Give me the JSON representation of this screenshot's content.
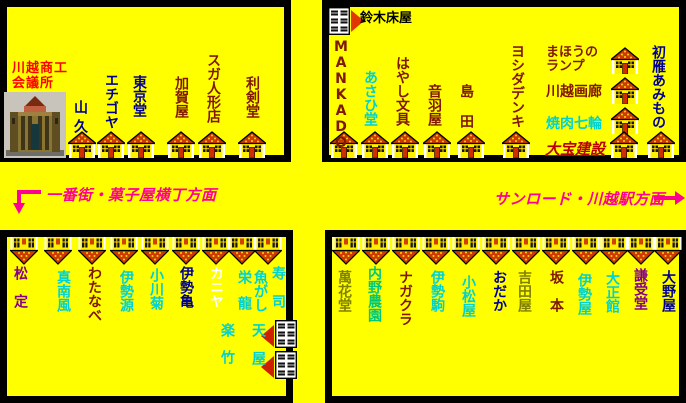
{
  "palette": {
    "background": "#FFFF00",
    "navy": "#000090",
    "maroon": "#801800",
    "olive": "#808000",
    "cyan": "#00D2D2",
    "green": "#00C878",
    "purple": "#850085",
    "white": "#FFFFFF",
    "red": "#FF0000",
    "darkred": "#B80000",
    "magenta": "#FF0095",
    "black": "#000000",
    "roof": "#CC3A00",
    "roof_dot": "#FFD800"
  },
  "landmark": {
    "name_line1": "川越商工",
    "name_line2": "会議所"
  },
  "directions": {
    "left": {
      "label": "一番街・菓子屋横丁方面"
    },
    "right": {
      "label": "サンロード・川越駅方面"
    }
  },
  "map_blocks": [
    {
      "id": "north-west",
      "x": 0,
      "y": 0,
      "w": 291,
      "h": 162,
      "shops": [
        {
          "name": "山久",
          "color": "navy",
          "dir": "v",
          "x": 73,
          "y": 100,
          "sp": 5
        },
        {
          "name": "エチゴヤ",
          "color": "navy",
          "dir": "v",
          "x": 104,
          "y": 73
        },
        {
          "name": "東京堂",
          "color": "navy",
          "dir": "v",
          "x": 132,
          "y": 75
        },
        {
          "name": "加賀屋",
          "color": "maroon",
          "dir": "v",
          "x": 174,
          "y": 76
        },
        {
          "name": "スガ人形店",
          "color": "maroon",
          "dir": "v",
          "x": 206,
          "y": 53
        },
        {
          "name": "利剣堂",
          "color": "maroon",
          "dir": "v",
          "x": 245,
          "y": 76
        }
      ],
      "houses": [
        {
          "type": "up",
          "x": 68,
          "y": 131
        },
        {
          "type": "up",
          "x": 97,
          "y": 131
        },
        {
          "type": "up",
          "x": 127,
          "y": 131
        },
        {
          "type": "up",
          "x": 167,
          "y": 131
        },
        {
          "type": "up",
          "x": 198,
          "y": 131
        },
        {
          "type": "up",
          "x": 238,
          "y": 131
        }
      ]
    },
    {
      "id": "north-east",
      "x": 322,
      "y": 0,
      "w": 364,
      "h": 162,
      "shops": [
        {
          "name": "鈴木床屋",
          "color": "black",
          "dir": "h",
          "x": 360,
          "y": 12,
          "fs": 13
        },
        {
          "name": "MANKADO",
          "color": "maroon",
          "dir": "v",
          "x": 334,
          "y": 39
        },
        {
          "name": "あさひ堂",
          "color": "cyan",
          "dir": "v",
          "x": 363,
          "y": 70
        },
        {
          "name": "はやし文具",
          "color": "maroon",
          "dir": "v",
          "x": 395,
          "y": 56
        },
        {
          "name": "音羽屋",
          "color": "maroon",
          "dir": "v",
          "x": 427,
          "y": 84
        },
        {
          "name": "島田",
          "color": "maroon",
          "dir": "v",
          "x": 459,
          "y": 84,
          "sp": 16
        },
        {
          "name": "ヨシダデンキ",
          "color": "maroon",
          "dir": "v",
          "x": 510,
          "y": 44
        },
        {
          "name": "まほうの\nランプ",
          "color": "maroon",
          "dir": "h",
          "x": 546,
          "y": 46,
          "fs": 13
        },
        {
          "name": "川越画廊",
          "color": "maroon",
          "dir": "h",
          "x": 546,
          "y": 85
        },
        {
          "name": "焼肉七輪",
          "color": "cyan",
          "dir": "h",
          "x": 546,
          "y": 117
        },
        {
          "name": "大宝建設",
          "color": "darkred",
          "dir": "h",
          "x": 545,
          "y": 141,
          "fs": 15,
          "style": "u-i"
        },
        {
          "name": "初雁あみもの",
          "color": "navy",
          "dir": "v",
          "x": 651,
          "y": 45
        }
      ],
      "houses": [
        {
          "type": "store",
          "x": 328,
          "y": 7,
          "arrow": "right",
          "ax": 351,
          "ay": 10
        },
        {
          "type": "up",
          "x": 611,
          "y": 47
        },
        {
          "type": "up",
          "x": 611,
          "y": 77
        },
        {
          "type": "up",
          "x": 611,
          "y": 107
        },
        {
          "type": "up",
          "x": 330,
          "y": 131
        },
        {
          "type": "up",
          "x": 361,
          "y": 131
        },
        {
          "type": "up",
          "x": 391,
          "y": 131
        },
        {
          "type": "up",
          "x": 423,
          "y": 131
        },
        {
          "type": "up",
          "x": 457,
          "y": 131
        },
        {
          "type": "up",
          "x": 502,
          "y": 131
        },
        {
          "type": "up",
          "x": 610,
          "y": 131
        },
        {
          "type": "up",
          "x": 647,
          "y": 131
        }
      ]
    },
    {
      "id": "south-west",
      "x": 0,
      "y": 230,
      "w": 293,
      "h": 173,
      "shops": [
        {
          "name": "松定",
          "color": "purple",
          "dir": "v",
          "x": 13,
          "y": 266,
          "sp": 14
        },
        {
          "name": "真南風",
          "color": "cyan",
          "dir": "v",
          "x": 56,
          "y": 270
        },
        {
          "name": "わたなべ",
          "color": "maroon",
          "dir": "v",
          "x": 87,
          "y": 266
        },
        {
          "name": "伊勢源",
          "color": "cyan",
          "dir": "v",
          "x": 119,
          "y": 270
        },
        {
          "name": "小川菊",
          "color": "cyan",
          "dir": "v",
          "x": 149,
          "y": 268
        },
        {
          "name": "伊勢亀",
          "color": "navy",
          "dir": "v",
          "x": 179,
          "y": 266
        },
        {
          "name": "カニヤ",
          "color": "white",
          "dir": "v",
          "x": 209,
          "y": 266
        },
        {
          "name": "栄龍",
          "color": "cyan",
          "dir": "v",
          "x": 237,
          "y": 270,
          "sp": 12
        },
        {
          "name": "魚がし",
          "color": "cyan",
          "dir": "v",
          "x": 253,
          "y": 270
        },
        {
          "name": "寿司",
          "color": "cyan",
          "dir": "v",
          "x": 271,
          "y": 266,
          "sp": 14
        },
        {
          "name": "楽竹",
          "color": "cyan",
          "dir": "v",
          "x": 220,
          "y": 323,
          "sp": 13
        },
        {
          "name": "天屋",
          "color": "cyan",
          "dir": "v",
          "x": 251,
          "y": 323,
          "sp": 14
        }
      ],
      "houses": [
        {
          "type": "down",
          "x": 10,
          "y": 237
        },
        {
          "type": "down",
          "x": 44,
          "y": 237
        },
        {
          "type": "down",
          "x": 78,
          "y": 237
        },
        {
          "type": "down",
          "x": 110,
          "y": 237
        },
        {
          "type": "down",
          "x": 141,
          "y": 237
        },
        {
          "type": "down",
          "x": 172,
          "y": 237
        },
        {
          "type": "down",
          "x": 202,
          "y": 237
        },
        {
          "type": "down",
          "x": 228,
          "y": 237
        },
        {
          "type": "down",
          "x": 254,
          "y": 237
        },
        {
          "type": "store",
          "x": 275,
          "y": 320,
          "arrow": "left",
          "ax": 261,
          "ay": 325
        },
        {
          "type": "store",
          "x": 275,
          "y": 351,
          "arrow": "left",
          "ax": 261,
          "ay": 356
        }
      ]
    },
    {
      "id": "south-east",
      "x": 325,
      "y": 230,
      "w": 361,
      "h": 173,
      "shops": [
        {
          "name": "萬花堂",
          "color": "olive",
          "dir": "v",
          "x": 337,
          "y": 270
        },
        {
          "name": "内野農園",
          "color": "green",
          "dir": "v",
          "x": 367,
          "y": 266
        },
        {
          "name": "ナガクラ",
          "color": "maroon",
          "dir": "v",
          "x": 398,
          "y": 270
        },
        {
          "name": "伊勢駒",
          "color": "cyan",
          "dir": "v",
          "x": 430,
          "y": 270
        },
        {
          "name": "小松屋",
          "color": "cyan",
          "dir": "v",
          "x": 461,
          "y": 275
        },
        {
          "name": "おだか",
          "color": "navy",
          "dir": "v",
          "x": 492,
          "y": 270
        },
        {
          "name": "吉田屋",
          "color": "olive",
          "dir": "v",
          "x": 517,
          "y": 270
        },
        {
          "name": "坂本",
          "color": "maroon",
          "dir": "v",
          "x": 549,
          "y": 270,
          "sp": 14
        },
        {
          "name": "伊勢屋",
          "color": "cyan",
          "dir": "v",
          "x": 577,
          "y": 273
        },
        {
          "name": "大正館",
          "color": "cyan",
          "dir": "v",
          "x": 605,
          "y": 271
        },
        {
          "name": "謙受堂",
          "color": "purple",
          "dir": "v",
          "x": 633,
          "y": 268
        },
        {
          "name": "大野屋",
          "color": "navy",
          "dir": "v",
          "x": 661,
          "y": 270
        }
      ],
      "houses": [
        {
          "type": "down",
          "x": 332,
          "y": 237
        },
        {
          "type": "down",
          "x": 362,
          "y": 237
        },
        {
          "type": "down",
          "x": 392,
          "y": 237
        },
        {
          "type": "down",
          "x": 422,
          "y": 237
        },
        {
          "type": "down",
          "x": 452,
          "y": 237
        },
        {
          "type": "down",
          "x": 482,
          "y": 237
        },
        {
          "type": "down",
          "x": 512,
          "y": 237
        },
        {
          "type": "down",
          "x": 542,
          "y": 237
        },
        {
          "type": "down",
          "x": 572,
          "y": 237
        },
        {
          "type": "down",
          "x": 600,
          "y": 237
        },
        {
          "type": "down",
          "x": 627,
          "y": 237
        },
        {
          "type": "down",
          "x": 654,
          "y": 237
        }
      ]
    }
  ]
}
